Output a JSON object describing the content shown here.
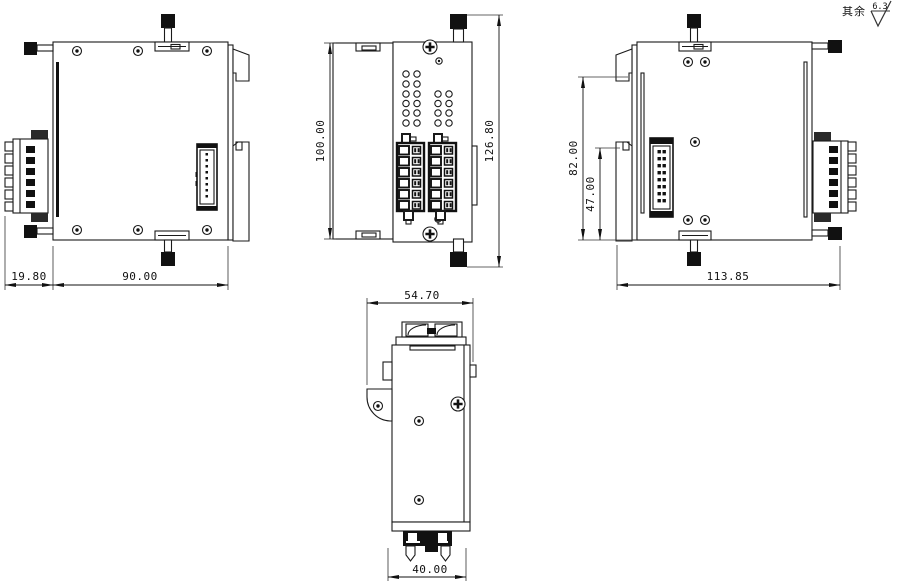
{
  "annotation": {
    "note_prefix": "其余",
    "roughness_value": "6.3"
  },
  "views": {
    "left_side": {
      "dim_connector_depth": "19.80",
      "dim_body_width": "90.00"
    },
    "front": {
      "dim_body_height": "100.00",
      "dim_overall_height": "126.80"
    },
    "right_side": {
      "dim_clip_height": "82.00",
      "dim_lower_height": "47.00",
      "dim_overall_width": "113.85"
    },
    "bottom": {
      "dim_overall_depth": "54.70",
      "dim_terminal_width": "40.00"
    }
  }
}
